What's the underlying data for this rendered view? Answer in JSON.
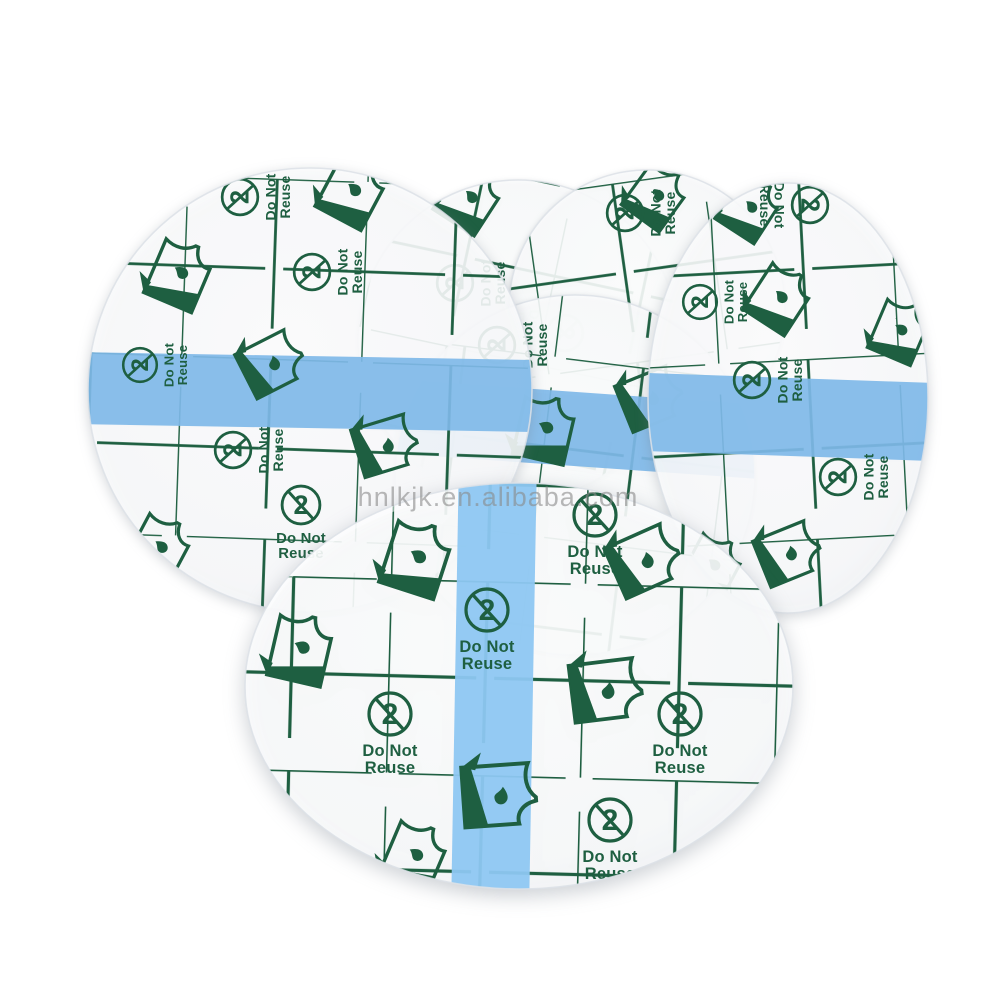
{
  "image": {
    "type": "product-photo",
    "subject": "Six round transparent waterproof adhesive film wound dressings with printed green grid release liners, overlapped on a white background",
    "patch_count": 6
  },
  "watermark": {
    "text": "hnlkjk.en.alibaba.com"
  },
  "labels": {
    "do_not": "Do Not",
    "reuse": "Reuse",
    "numeral_two": "2"
  },
  "icons": {
    "do_not_reuse": "crossed-numeral-2-in-circle",
    "film_sheet": "curled-film-sheet-with-droplet"
  },
  "colors": {
    "grid_green": "#1e5f41",
    "stripe_blue_back": "#7fb9e8",
    "stripe_blue_front": "#8ec7f2",
    "patch_white": "#fbfbfd",
    "rim_gray": "#dde2e8",
    "watermark_gray": "#8a8a8a",
    "background": "#ffffff"
  }
}
